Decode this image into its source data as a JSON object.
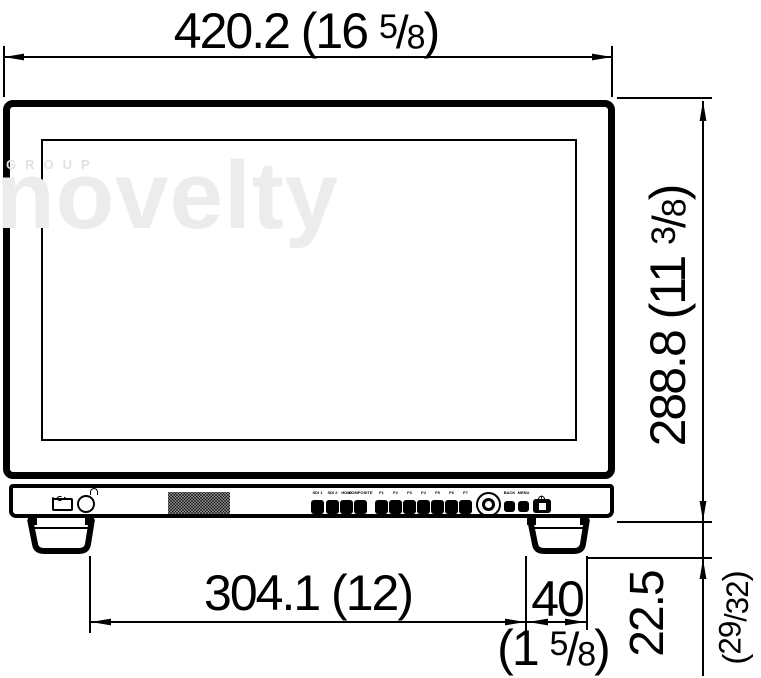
{
  "watermark": {
    "top": "GROUP",
    "main": "novelty"
  },
  "colors": {
    "line": "#000000",
    "background": "#ffffff",
    "watermark_main": "#ececec",
    "watermark_top": "#e2e2e2"
  },
  "dimensions": {
    "top": {
      "mm": "420.2",
      "inch_open": " (16 ",
      "frac_num": "5",
      "slash": "/",
      "frac_den": "8",
      "inch_close": ")"
    },
    "right": {
      "mm": "288.8",
      "inch_open": " (11 ",
      "frac_num": "3",
      "slash": "/",
      "frac_den": "8",
      "inch_close": ")"
    },
    "bottom": {
      "mm": "304.1",
      "inch": " (12)"
    },
    "foot_width": {
      "mm": "40"
    },
    "foot_width_inch": {
      "inch_open": "(1 ",
      "frac_num": "5",
      "slash": "/",
      "frac_den": "8",
      "inch_close": ")"
    },
    "foot_height": {
      "mm": "22.5",
      "inch_open": "(",
      "frac_num": "29",
      "slash": "/",
      "frac_den": "32",
      "inch_close": ")"
    }
  },
  "controls": {
    "input_buttons": [
      {
        "label": "SDI 1"
      },
      {
        "label": "SDI 2"
      },
      {
        "label": "HDMI"
      },
      {
        "label": "COMPOSITE"
      }
    ],
    "function_buttons": [
      {
        "label": "F1"
      },
      {
        "label": "F2"
      },
      {
        "label": "F3"
      },
      {
        "label": "F4"
      },
      {
        "label": "F5"
      },
      {
        "label": "F6"
      },
      {
        "label": "F7"
      }
    ],
    "nav_buttons": [
      {
        "label": "BACK"
      },
      {
        "label": "MENU"
      }
    ],
    "icons": {
      "usb_icon": "usb trident glyph",
      "headphone_icon": "headphone arc glyph",
      "power_icon": "standby circle glyph",
      "speaker_grille": "dot matrix grille"
    }
  }
}
